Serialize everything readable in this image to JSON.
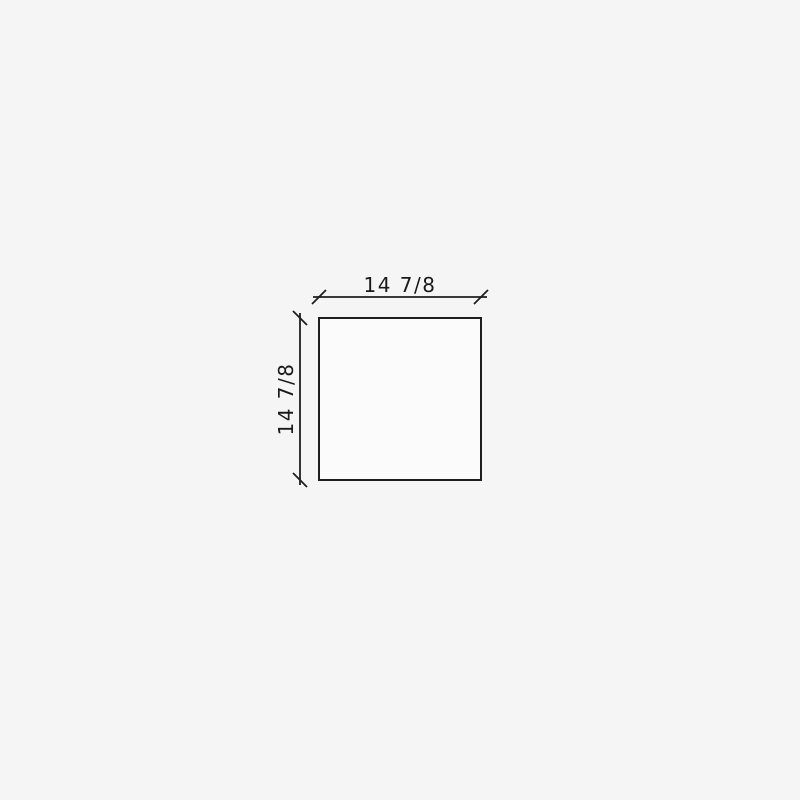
{
  "page": {
    "canvas_background": "#f5f5f5"
  },
  "drawing": {
    "line_color": "#1e1e1e",
    "text_color": "#1a1a1a",
    "shape": {
      "fill": "#fbfbfb",
      "stroke": "#1e1e1e"
    },
    "dimensions": {
      "width": {
        "label": "14 7/8"
      },
      "height": {
        "label": "14 7/8"
      }
    }
  }
}
